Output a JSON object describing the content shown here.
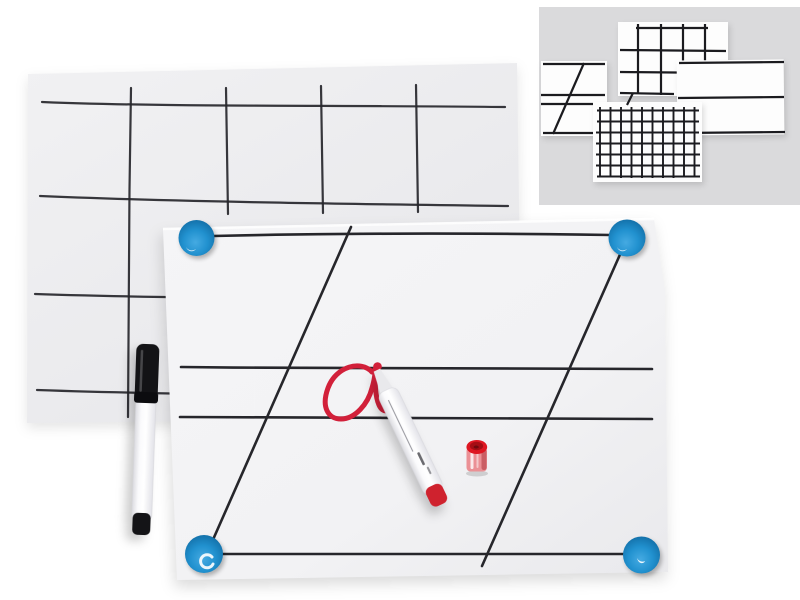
{
  "image": {
    "kind": "product-photo",
    "subject": "Magnetic dry-erase whiteboard sheets with hand-drawn layouts, two markers, a red cap and four blue corner magnets; inset panel of four pattern variants"
  },
  "colors": {
    "page_bg": "#ffffff",
    "back_sheet_fill": "#eeeef0",
    "front_sheet_fill": "#f2f2f4",
    "line_dark": "#26262b",
    "mini_line": "#1b1b1f",
    "inset_bg": "#dadadc",
    "mini_sheet_fill": "#fdfdfd",
    "magnet_blue_bright": "#45aae2",
    "magnet_blue": "#2191cf",
    "magnet_blue_deep": "#11639a",
    "marker_red": "#d2203a",
    "cap_red_top": "#de1722",
    "cap_red_inner": "#a50d14",
    "cap_pink_body": "#eb9095",
    "marker_white_body": "#f8f8fa",
    "marker_black": "#131316"
  },
  "objects": {
    "back_sheet": {
      "label": "rear whiteboard sheet with hand-drawn table grid"
    },
    "front_sheet": {
      "label": "front whiteboard sheet with ruled lines and two diagonals"
    },
    "magnet_top_left": {
      "label": "round blue magnet, top left corner"
    },
    "magnet_top_right": {
      "label": "round blue magnet, top right corner"
    },
    "magnet_bottom_left": {
      "label": "round blue magnet, bottom left corner"
    },
    "magnet_bottom_right": {
      "label": "round blue magnet, bottom right corner"
    },
    "black_marker": {
      "label": "capped black dry-erase marker"
    },
    "red_marker": {
      "label": "uncapped white-bodied red dry-erase marker"
    },
    "red_cap": {
      "label": "red marker cap standing upright"
    },
    "red_writing": {
      "label": "red handwritten cursive letter a"
    },
    "inset_panel": {
      "label": "inset panel of sheet pattern variants"
    },
    "inset_variants": {
      "coarse_grid": {
        "label": "coarse grid sheet variant"
      },
      "writing_lines": {
        "label": "writing lines with diagonal sheet variant"
      },
      "plain_lines": {
        "label": "plain horizontal lines sheet variant"
      },
      "fine_grid": {
        "label": "fine grid sheet variant"
      }
    }
  }
}
